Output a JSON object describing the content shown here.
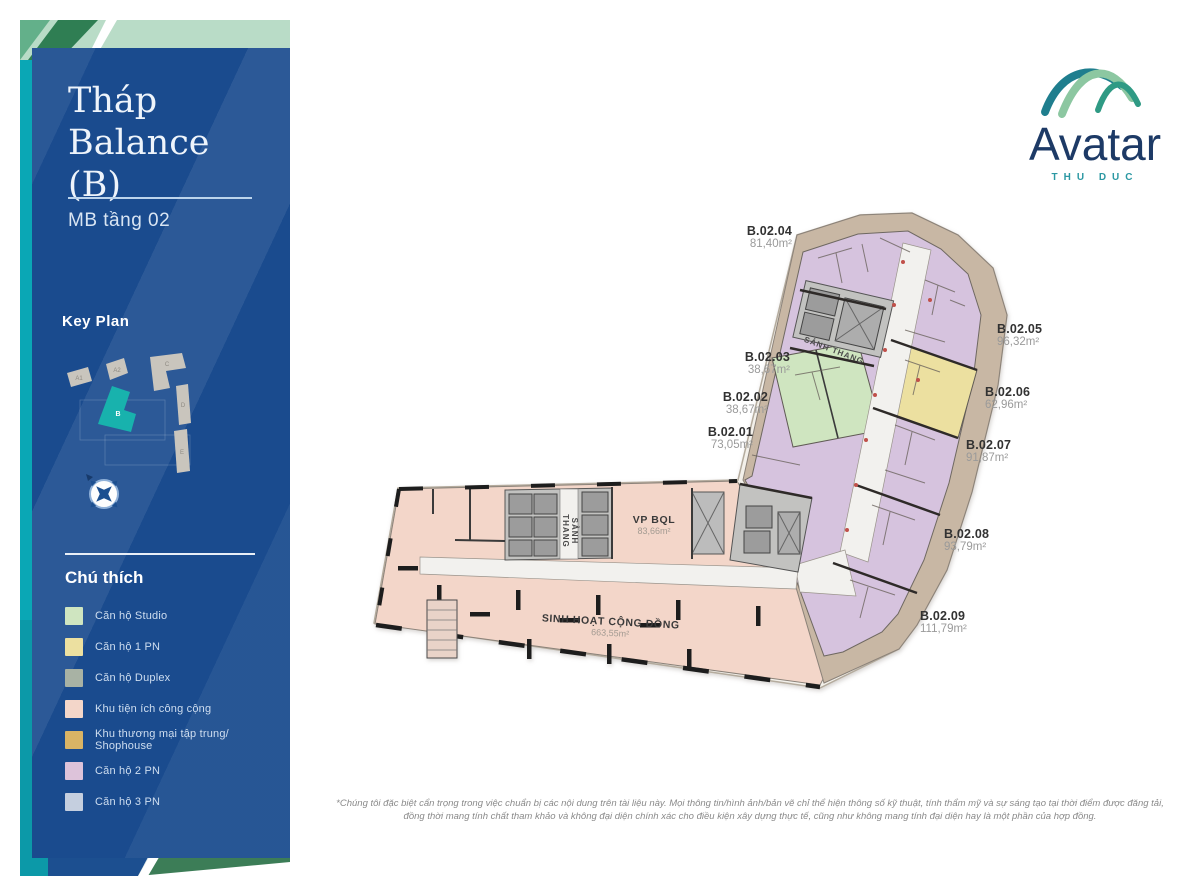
{
  "sidebar": {
    "title_line1": "Tháp",
    "title_line2": "Balance (B)",
    "subtitle": "MB tầng 02",
    "keyplan": {
      "title": "Key Plan",
      "buildings": [
        "A1",
        "A2",
        "B",
        "C",
        "D",
        "E"
      ]
    },
    "legend": {
      "title": "Chú thích",
      "items": [
        {
          "label": "Căn hộ Studio",
          "color": "#cfe5c0"
        },
        {
          "label": "Căn hộ 1 PN",
          "color": "#ece0a0"
        },
        {
          "label": "Căn hộ Duplex",
          "color": "#a8b2a4"
        },
        {
          "label": "Khu tiện ích công cộng",
          "color": "#f3d6c9"
        },
        {
          "label": "Khu thương mại tập trung/ Shophouse",
          "color": "#d9b465"
        },
        {
          "label": "Căn hộ 2 PN",
          "color": "#ddc3da"
        },
        {
          "label": "Căn hộ 3 PN",
          "color": "#c5cfdf"
        }
      ]
    }
  },
  "logo": {
    "brand": "Avatar",
    "sub": "THU DUC"
  },
  "plan": {
    "units": [
      {
        "id": "B.02.01",
        "area": "73,05m²"
      },
      {
        "id": "B.02.02",
        "area": "38,67m²"
      },
      {
        "id": "B.02.03",
        "area": "38,67m²"
      },
      {
        "id": "B.02.04",
        "area": "81,40m²"
      },
      {
        "id": "B.02.05",
        "area": "96,32m²"
      },
      {
        "id": "B.02.06",
        "area": "62,96m²"
      },
      {
        "id": "B.02.07",
        "area": "91,87m²"
      },
      {
        "id": "B.02.08",
        "area": "93,79m²"
      },
      {
        "id": "B.02.09",
        "area": "111,79m²"
      }
    ],
    "rooms": {
      "lobby1": "SẢNH THANG",
      "lobby2": "SẢNH THANG",
      "office_label": "VP BQL",
      "office_area": "83,66m²",
      "community_label": "SINH HOẠT CỘNG ĐỒNG",
      "community_area": "663,55m²"
    }
  },
  "footer": {
    "disclaimer": "*Chúng tôi đặc biệt cẩn trọng trong việc chuẩn bị các nội dung trên tài liệu này. Mọi thông tin/hình ảnh/bản vẽ chỉ thể hiện thông số kỹ thuật, tính thẩm mỹ và sự sáng tạo tại thời điểm được đăng tải, đồng thời mang tính chất tham khảo và không đại diện chính xác cho điều kiện xây dựng thực tế, cũng như không mang tính đại diện hay là một phần của hợp đồng."
  }
}
